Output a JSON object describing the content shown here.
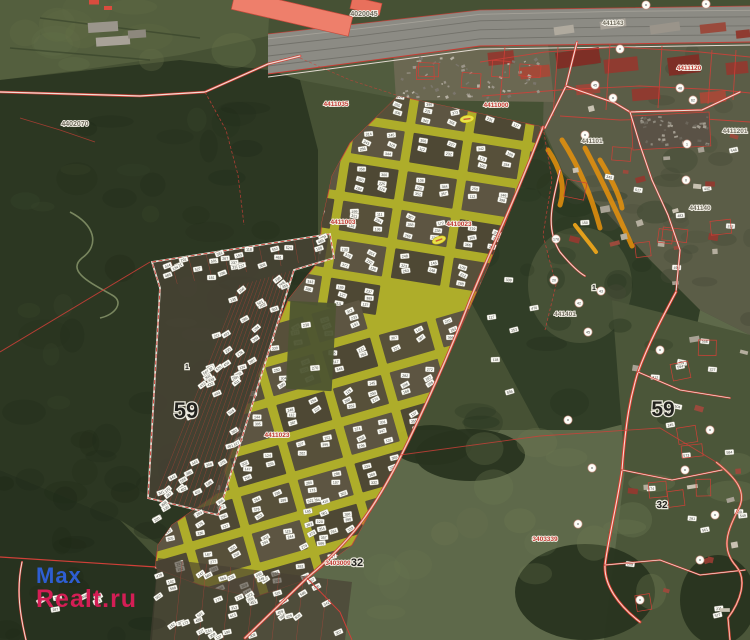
{
  "source": {
    "watermark_line1": "Max",
    "watermark_line2": "Realt.ru"
  },
  "map": {
    "type": "satellite-cadastral-map",
    "highlight_area_color": "#b3b12a",
    "cadastral_line_color": "#d04038",
    "road_fill_color": "#efc9ba",
    "parcel_tag_color": "#fcfcf5",
    "autumn_streak_color": "#e8920c",
    "district_labels": [
      {
        "t": "59",
        "x": 186,
        "y": 418,
        "c": "dark",
        "s": 22
      },
      {
        "t": "59",
        "x": 663,
        "y": 416,
        "c": "dark",
        "s": 21
      },
      {
        "t": "32",
        "x": 357,
        "y": 566,
        "c": "dark",
        "s": 11
      },
      {
        "t": "32",
        "x": 662,
        "y": 508,
        "c": "dark",
        "s": 10
      },
      {
        "t": "1",
        "x": 594,
        "y": 290,
        "c": "dark",
        "s": 7
      },
      {
        "t": "1",
        "x": 187,
        "y": 369,
        "c": "dark",
        "s": 7
      }
    ],
    "quarter_codes": [
      {
        "t": "4020045",
        "x": 364,
        "y": 16,
        "c": "gray",
        "s": 7
      },
      {
        "t": "4402070",
        "x": 75,
        "y": 126,
        "c": "gray",
        "s": 7
      },
      {
        "t": "441143",
        "x": 613,
        "y": 25,
        "c": "gray",
        "s": 6.5
      },
      {
        "t": "4411201",
        "x": 735,
        "y": 133,
        "c": "gray",
        "s": 6.5
      },
      {
        "t": "441101",
        "x": 592,
        "y": 143,
        "c": "gray",
        "s": 6.5
      },
      {
        "t": "441140",
        "x": 700,
        "y": 210,
        "c": "gray",
        "s": 6.5
      },
      {
        "t": "441401",
        "x": 565,
        "y": 316,
        "c": "gray",
        "s": 6.5
      },
      {
        "t": "4411120",
        "x": 689,
        "y": 70,
        "c": "red",
        "s": 6.5
      },
      {
        "t": "4411000",
        "x": 496,
        "y": 107,
        "c": "red",
        "s": 6.5
      },
      {
        "t": "4411035",
        "x": 336,
        "y": 106,
        "c": "red",
        "s": 6.5
      },
      {
        "t": "4411003",
        "x": 343,
        "y": 224,
        "c": "red",
        "s": 6.5
      },
      {
        "t": "4410023",
        "x": 459,
        "y": 226,
        "c": "red",
        "s": 6.5
      },
      {
        "t": "4411023",
        "x": 277,
        "y": 437,
        "c": "red",
        "s": 6.5
      },
      {
        "t": "3403009",
        "x": 338,
        "y": 565,
        "c": "red",
        "s": 6.5
      },
      {
        "t": "3403339",
        "x": 545,
        "y": 541,
        "c": "red",
        "s": 6.5
      }
    ],
    "poi_markers": [
      {
        "x": 646,
        "y": 5,
        "t": ""
      },
      {
        "x": 706,
        "y": 4,
        "t": ""
      },
      {
        "x": 620,
        "y": 49,
        "t": ""
      },
      {
        "x": 595,
        "y": 85,
        "t": "45"
      },
      {
        "x": 613,
        "y": 98,
        "t": ""
      },
      {
        "x": 680,
        "y": 88,
        "t": "48"
      },
      {
        "x": 693,
        "y": 100,
        "t": "62"
      },
      {
        "x": 585,
        "y": 135,
        "t": ""
      },
      {
        "x": 556,
        "y": 239,
        "t": "178"
      },
      {
        "x": 554,
        "y": 280,
        "t": "20"
      },
      {
        "x": 579,
        "y": 303,
        "t": "42"
      },
      {
        "x": 601,
        "y": 291,
        "t": "43"
      },
      {
        "x": 588,
        "y": 332,
        "t": "45"
      },
      {
        "x": 687,
        "y": 144,
        "t": "1"
      },
      {
        "x": 686,
        "y": 180,
        "t": "0"
      },
      {
        "x": 568,
        "y": 420,
        "t": ""
      },
      {
        "x": 592,
        "y": 468,
        "t": ""
      },
      {
        "x": 578,
        "y": 524,
        "t": ""
      },
      {
        "x": 640,
        "y": 600,
        "t": ""
      },
      {
        "x": 660,
        "y": 350,
        "t": ""
      },
      {
        "x": 710,
        "y": 430,
        "t": ""
      },
      {
        "x": 685,
        "y": 470,
        "t": ""
      },
      {
        "x": 715,
        "y": 515,
        "t": ""
      },
      {
        "x": 700,
        "y": 560,
        "t": ""
      }
    ],
    "big_parcel_labels": [
      "230",
      "270"
    ]
  }
}
